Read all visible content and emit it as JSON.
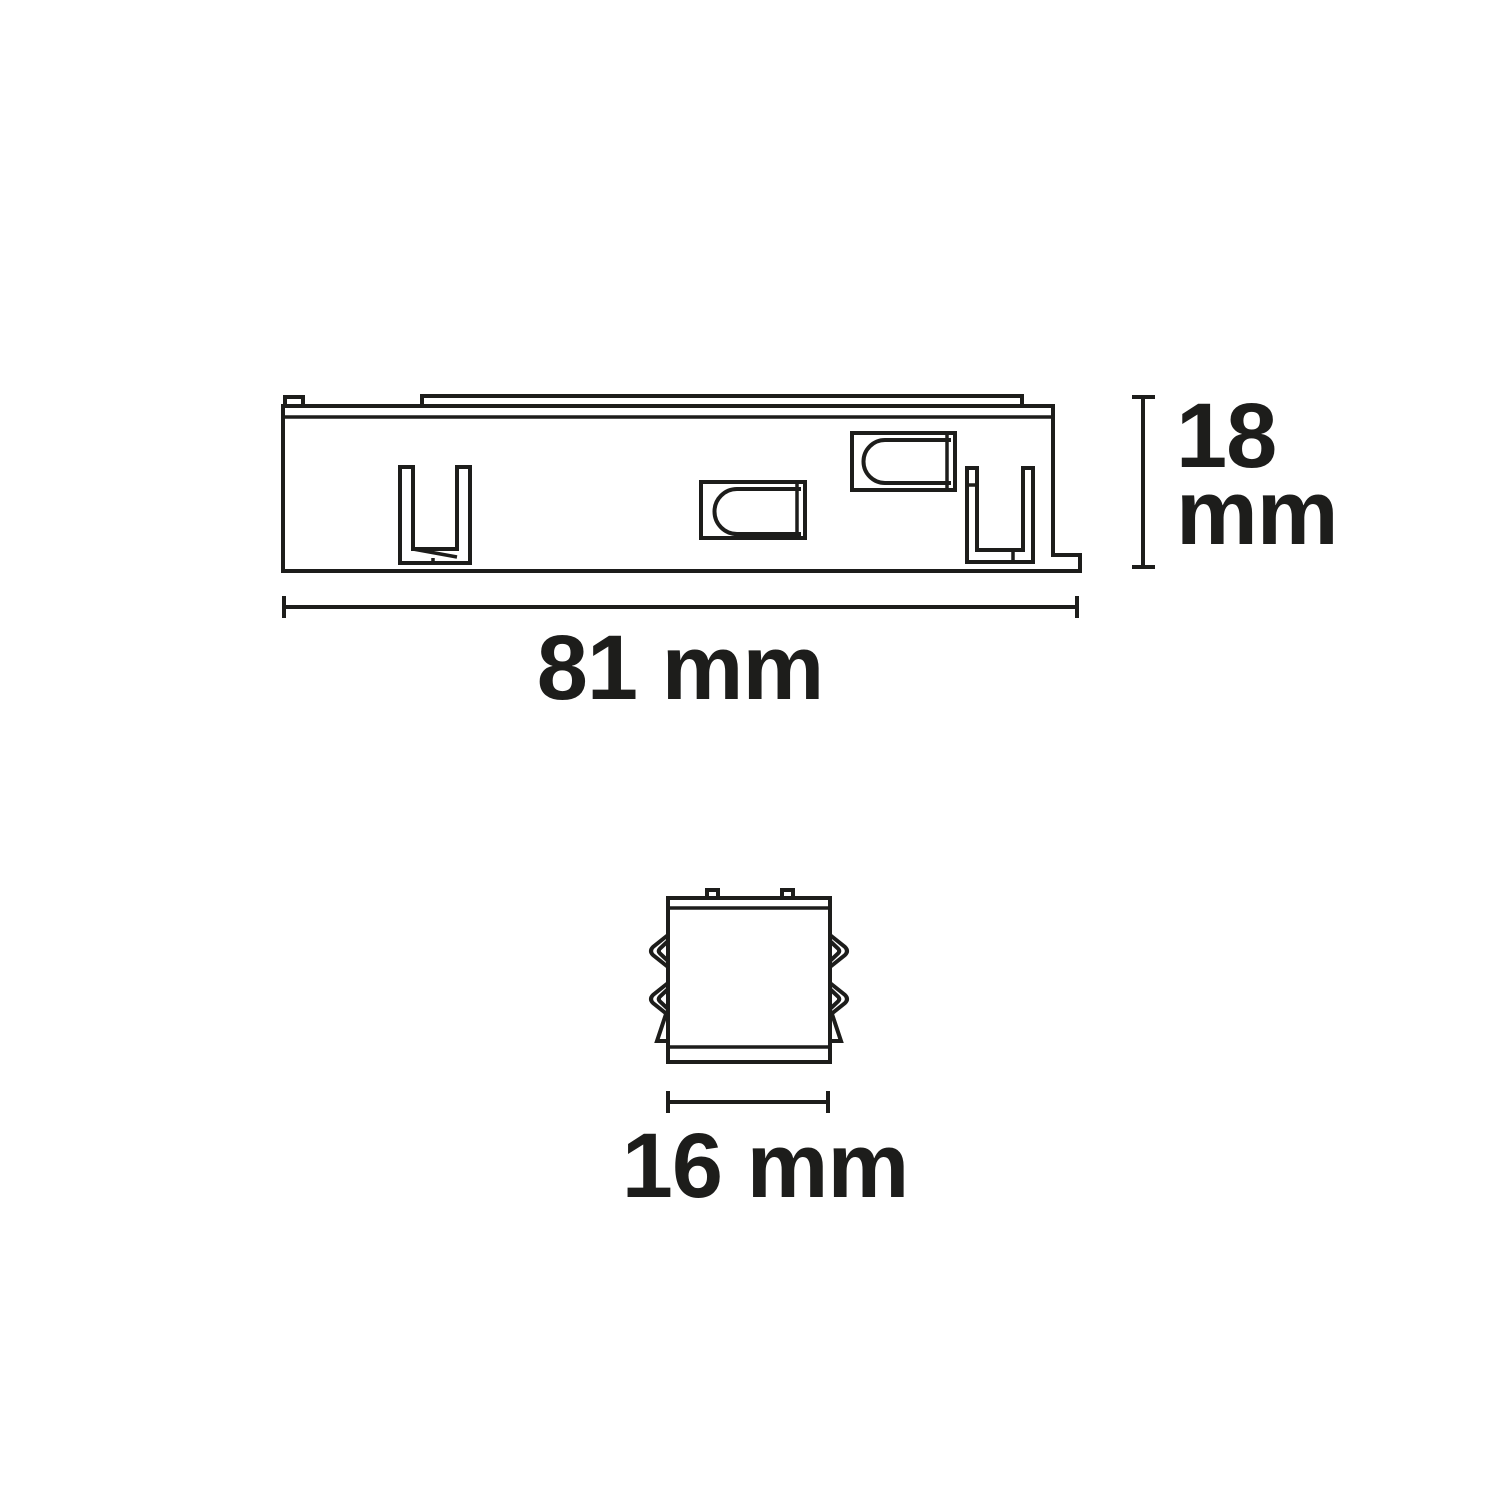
{
  "colors": {
    "background": "#ffffff",
    "line": "#1d1d1b",
    "text": "#1d1d1b"
  },
  "dimensions": {
    "height": {
      "value": "18",
      "unit": "mm",
      "label": "18 mm"
    },
    "width": {
      "value": "81",
      "unit": "mm",
      "label": "81 mm"
    },
    "depth": {
      "value": "16",
      "unit": "mm",
      "label": "16 mm"
    }
  }
}
